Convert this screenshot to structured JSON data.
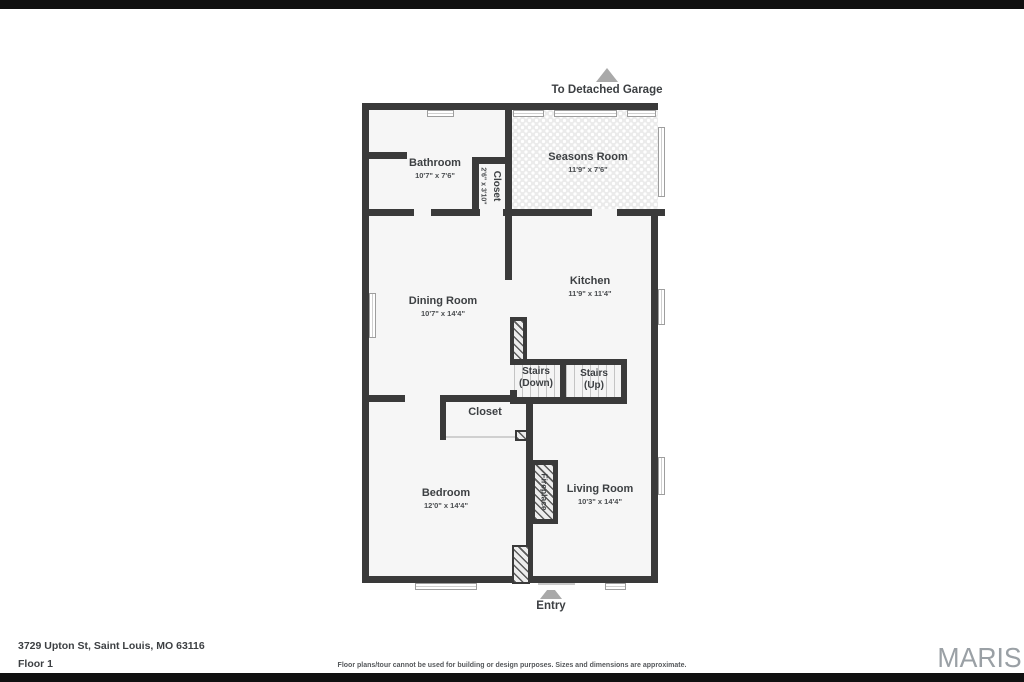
{
  "plan": {
    "wall_color": "#3a3a3a",
    "floor_color": "#f6f6f6",
    "arrow_color": "#a9a9a9"
  },
  "annotations": {
    "garage_label": "To Detached Garage",
    "entry_label": "Entry"
  },
  "rooms": [
    {
      "name": "Bathroom",
      "dims": "10'7\" x 7'6\""
    },
    {
      "name": "Closet",
      "dims": "2'6\" x 3'10\""
    },
    {
      "name": "Seasons Room",
      "dims": "11'9\" x 7'6\""
    },
    {
      "name": "Dining Room",
      "dims": "10'7\" x 14'4\""
    },
    {
      "name": "Kitchen",
      "dims": "11'9\" x 11'4\""
    },
    {
      "name": "Stairs",
      "dims": "(Down)"
    },
    {
      "name": "Stairs",
      "dims": "(Up)"
    },
    {
      "name": "Closet",
      "dims": ""
    },
    {
      "name": "Bedroom",
      "dims": "12'0\" x 14'4\""
    },
    {
      "name": "Fireplace",
      "dims": ""
    },
    {
      "name": "Living Room",
      "dims": "10'3\" x 14'4\""
    }
  ],
  "footer": {
    "address": "3729 Upton St, Saint Louis, MO 63116",
    "floor": "Floor 1",
    "disclaimer": "Floor plans/tour cannot be used for building or design purposes. Sizes and dimensions are approximate.",
    "brand": "MARIS"
  }
}
